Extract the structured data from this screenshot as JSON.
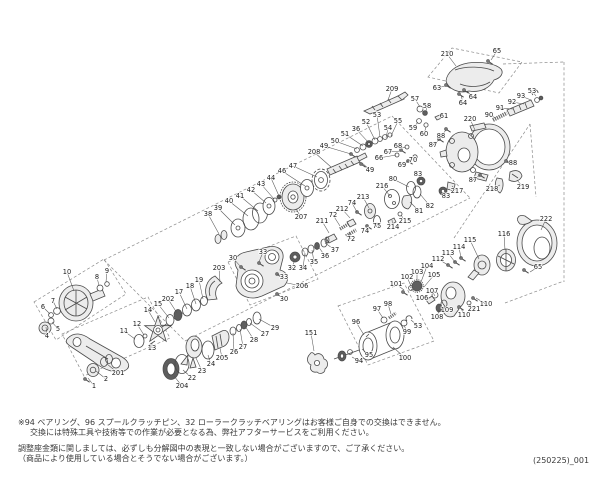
{
  "page": {
    "background": "#ffffff",
    "ink_color": "#4a4a4a",
    "label_color": "#1b1b1b"
  },
  "footer": {
    "notes": [
      "※94 ベアリング、96 スプールクラッチピン、32 ローラークラッチベアリングはお客様ご自身での交換はできません。",
      "交換には特殊工具や技術等での作業が必要となる為、弊社アフターサービスをご利用ください。",
      "調整座金類に関しましては、必ずしも分解図中の表現と一致しない場合がございますので、ご了承ください。",
      "（商品により使用している場合とそうでない場合がございます。）"
    ],
    "doc_number": "(250225)_001"
  },
  "diagram": {
    "kind": "exploded-view-parts-diagram",
    "subject": "baitcasting-fishing-reel",
    "labels": [
      [
        "210",
        447,
        54,
        456,
        66
      ],
      [
        "65",
        497,
        51,
        491,
        60
      ],
      [
        "63",
        437,
        88,
        445,
        86
      ],
      [
        "64",
        473,
        97,
        467,
        91
      ],
      [
        "64",
        463,
        103,
        461,
        95
      ],
      [
        "209",
        392,
        89,
        388,
        100
      ],
      [
        "57",
        415,
        99,
        420,
        107
      ],
      [
        "58",
        427,
        106,
        426,
        111
      ],
      [
        "59",
        413,
        128,
        418,
        122
      ],
      [
        "60",
        424,
        134,
        426,
        127
      ],
      [
        "61",
        444,
        116,
        440,
        118
      ],
      [
        "88",
        441,
        136,
        446,
        130
      ],
      [
        "87",
        433,
        145,
        440,
        139
      ],
      [
        "220",
        470,
        119,
        475,
        130
      ],
      [
        "90",
        489,
        115,
        496,
        118
      ],
      [
        "91",
        500,
        108,
        513,
        109
      ],
      [
        "92",
        512,
        102,
        524,
        104
      ],
      [
        "93",
        521,
        96,
        531,
        100
      ],
      [
        "53",
        532,
        91,
        536,
        96
      ],
      [
        "53",
        377,
        115,
        380,
        137
      ],
      [
        "55",
        398,
        121,
        391,
        136
      ],
      [
        "54",
        388,
        128,
        386,
        138
      ],
      [
        "52",
        366,
        122,
        375,
        140
      ],
      [
        "36",
        356,
        129,
        369,
        143
      ],
      [
        "51",
        345,
        134,
        363,
        146
      ],
      [
        "50",
        335,
        141,
        357,
        149
      ],
      [
        "49",
        324,
        146,
        351,
        154
      ],
      [
        "208",
        314,
        152,
        331,
        167
      ],
      [
        "68",
        398,
        146,
        406,
        148
      ],
      [
        "67",
        388,
        152,
        401,
        151
      ],
      [
        "66",
        379,
        158,
        396,
        155
      ],
      [
        "70",
        413,
        160,
        415,
        157
      ],
      [
        "69",
        402,
        165,
        408,
        161
      ],
      [
        "49",
        370,
        170,
        362,
        163
      ],
      [
        "47",
        293,
        166,
        317,
        177
      ],
      [
        "46",
        282,
        171,
        305,
        186
      ],
      [
        "44",
        271,
        178,
        279,
        196
      ],
      [
        "43",
        261,
        184,
        274,
        199
      ],
      [
        "42",
        251,
        190,
        266,
        203
      ],
      [
        "41",
        240,
        196,
        258,
        211
      ],
      [
        "40",
        229,
        201,
        248,
        216
      ],
      [
        "39",
        218,
        208,
        235,
        225
      ],
      [
        "38",
        208,
        214,
        219,
        234
      ],
      [
        "207",
        301,
        217,
        296,
        209
      ],
      [
        "83",
        418,
        174,
        421,
        180
      ],
      [
        "80",
        393,
        179,
        409,
        187
      ],
      [
        "216",
        382,
        186,
        390,
        196
      ],
      [
        "213",
        363,
        197,
        369,
        208
      ],
      [
        "74",
        352,
        203,
        357,
        212
      ],
      [
        "212",
        342,
        209,
        350,
        218
      ],
      [
        "72",
        333,
        215,
        340,
        226
      ],
      [
        "211",
        322,
        221,
        329,
        233
      ],
      [
        "72",
        351,
        239,
        349,
        232
      ],
      [
        "74",
        365,
        231,
        368,
        226
      ],
      [
        "75",
        377,
        226,
        377,
        222
      ],
      [
        "214",
        393,
        227,
        392,
        220
      ],
      [
        "215",
        405,
        221,
        401,
        215
      ],
      [
        "81",
        419,
        211,
        410,
        202
      ],
      [
        "82",
        430,
        206,
        420,
        194
      ],
      [
        "83",
        446,
        196,
        444,
        192
      ],
      [
        "217",
        457,
        191,
        452,
        186
      ],
      [
        "218",
        492,
        189,
        500,
        185
      ],
      [
        "219",
        523,
        187,
        517,
        180
      ],
      [
        "88",
        513,
        163,
        507,
        161
      ],
      [
        "87",
        473,
        180,
        480,
        175
      ],
      [
        "222",
        546,
        219,
        541,
        230
      ],
      [
        "116",
        504,
        234,
        505,
        250
      ],
      [
        "115",
        470,
        240,
        479,
        259
      ],
      [
        "114",
        459,
        247,
        461,
        258
      ],
      [
        "113",
        448,
        253,
        455,
        262
      ],
      [
        "112",
        438,
        259,
        448,
        265
      ],
      [
        "65",
        538,
        267,
        530,
        272
      ],
      [
        "104",
        427,
        266,
        421,
        282
      ],
      [
        "103",
        417,
        272,
        417,
        282
      ],
      [
        "102",
        407,
        277,
        411,
        286
      ],
      [
        "101",
        396,
        284,
        404,
        290
      ],
      [
        "105",
        434,
        275,
        424,
        287
      ],
      [
        "107",
        432,
        291,
        435,
        296
      ],
      [
        "106",
        422,
        298,
        428,
        299
      ],
      [
        "109",
        447,
        310,
        444,
        305
      ],
      [
        "108",
        437,
        317,
        439,
        310
      ],
      [
        "110",
        486,
        304,
        476,
        298
      ],
      [
        "221",
        474,
        309,
        469,
        304
      ],
      [
        "110",
        464,
        315,
        461,
        308
      ],
      [
        "98",
        388,
        304,
        391,
        314
      ],
      [
        "97",
        377,
        309,
        383,
        318
      ],
      [
        "96",
        356,
        322,
        364,
        335
      ],
      [
        "99",
        407,
        332,
        404,
        325
      ],
      [
        "53",
        418,
        326,
        411,
        320
      ],
      [
        "95",
        369,
        355,
        362,
        349
      ],
      [
        "94",
        359,
        361,
        352,
        357
      ],
      [
        "100",
        405,
        358,
        393,
        347
      ],
      [
        "151",
        311,
        333,
        314,
        351
      ],
      [
        "37",
        335,
        250,
        325,
        243
      ],
      [
        "36",
        325,
        256,
        318,
        246
      ],
      [
        "35",
        314,
        262,
        312,
        250
      ],
      [
        "34",
        303,
        268,
        305,
        253
      ],
      [
        "32",
        292,
        268,
        295,
        259
      ],
      [
        "33",
        263,
        252,
        259,
        262
      ],
      [
        "30",
        233,
        258,
        240,
        266
      ],
      [
        "33",
        284,
        277,
        277,
        274
      ],
      [
        "30",
        284,
        299,
        278,
        295
      ],
      [
        "206",
        302,
        286,
        287,
        283
      ],
      [
        "203",
        219,
        268,
        220,
        282
      ],
      [
        "19",
        199,
        280,
        203,
        299
      ],
      [
        "18",
        190,
        286,
        196,
        304
      ],
      [
        "17",
        179,
        292,
        187,
        309
      ],
      [
        "202",
        168,
        299,
        177,
        313
      ],
      [
        "15",
        158,
        304,
        169,
        318
      ],
      [
        "14",
        148,
        310,
        155,
        322
      ],
      [
        "13",
        152,
        348,
        152,
        343
      ],
      [
        "12",
        137,
        324,
        144,
        335
      ],
      [
        "11",
        124,
        331,
        135,
        339
      ],
      [
        "29",
        275,
        328,
        259,
        319
      ],
      [
        "27",
        265,
        334,
        250,
        323
      ],
      [
        "28",
        254,
        340,
        245,
        326
      ],
      [
        "27",
        243,
        347,
        240,
        329
      ],
      [
        "26",
        234,
        352,
        233,
        333
      ],
      [
        "205",
        222,
        358,
        220,
        348
      ],
      [
        "24",
        211,
        364,
        208,
        355
      ],
      [
        "23",
        202,
        371,
        196,
        358
      ],
      [
        "22",
        192,
        378,
        183,
        370
      ],
      [
        "204",
        182,
        386,
        174,
        376
      ],
      [
        "10",
        67,
        272,
        74,
        291
      ],
      [
        "9",
        107,
        271,
        106,
        282
      ],
      [
        "8",
        97,
        277,
        99,
        286
      ],
      [
        "7",
        53,
        301,
        57,
        309
      ],
      [
        "6",
        43,
        307,
        50,
        314
      ],
      [
        "5",
        58,
        329,
        52,
        322
      ],
      [
        "4",
        47,
        336,
        46,
        327
      ],
      [
        "201",
        118,
        373,
        107,
        364
      ],
      [
        "2",
        106,
        379,
        96,
        371
      ],
      [
        "1",
        94,
        386,
        88,
        378
      ]
    ]
  }
}
